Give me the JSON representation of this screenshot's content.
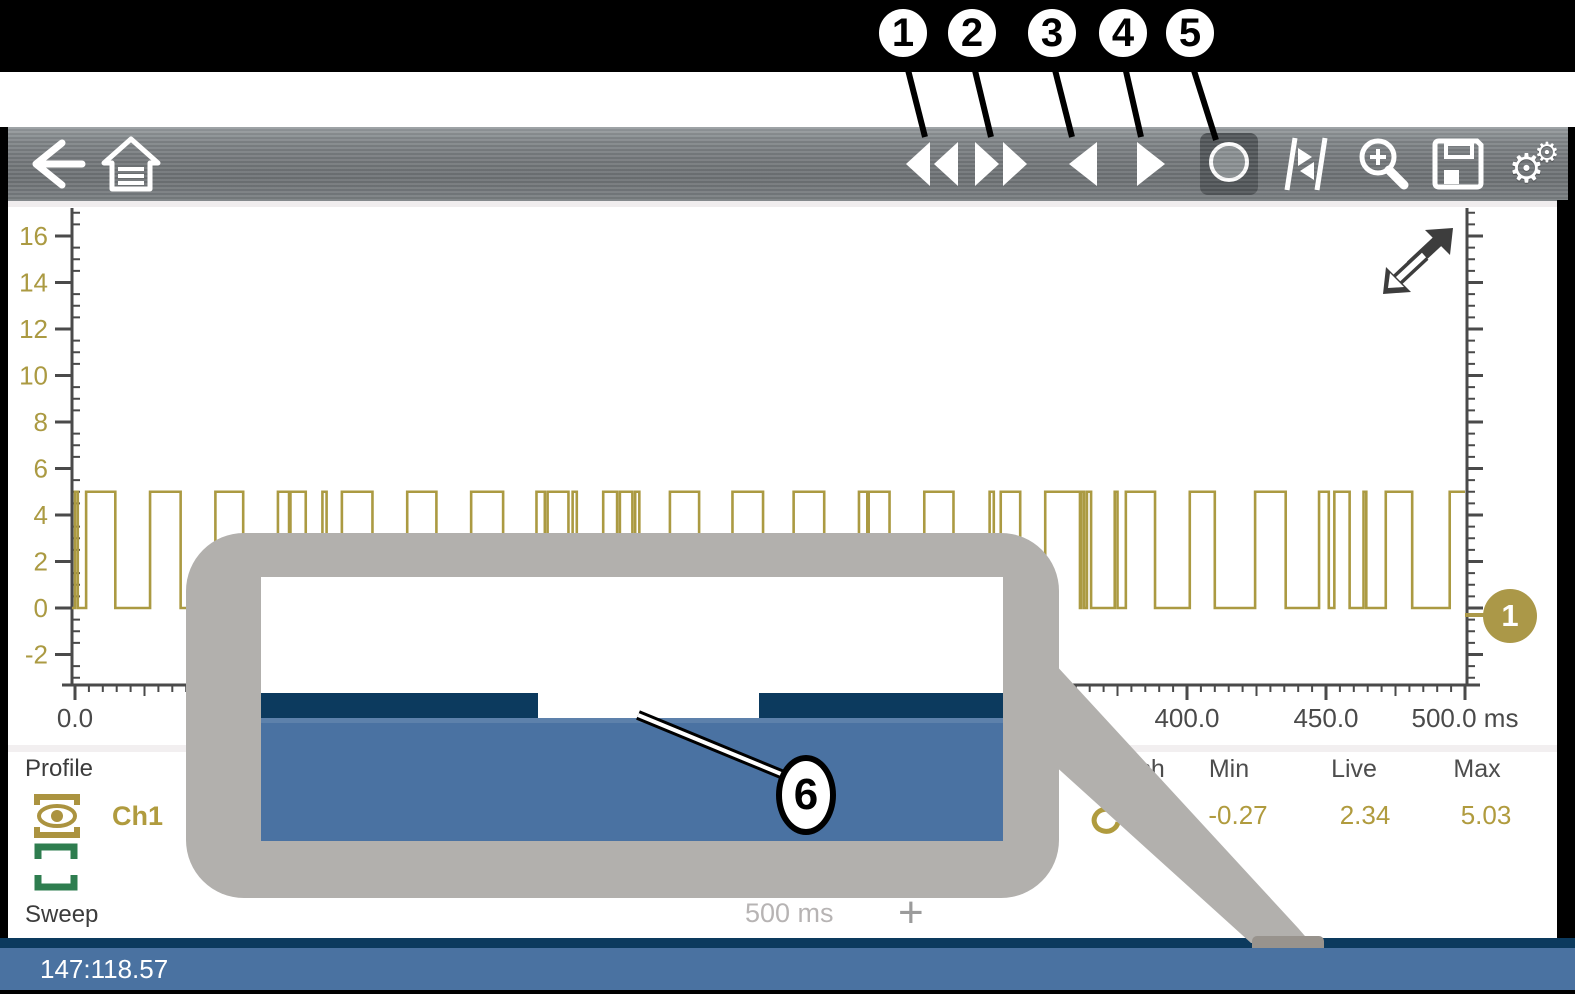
{
  "callouts": {
    "one": "1",
    "two": "2",
    "three": "3",
    "four": "4",
    "five": "5",
    "six": "6"
  },
  "toolbar": {
    "icons": [
      "back-arrow",
      "home",
      "rewind",
      "fast-forward",
      "step-back",
      "step-forward",
      "record",
      "cursors",
      "zoom-magnifier",
      "save-floppy",
      "settings-gears"
    ],
    "selected_button": "record"
  },
  "chart": {
    "badge_label": "1",
    "expand_icon": "expand-diagonal-arrows"
  },
  "chart_data": {
    "type": "line",
    "title": "",
    "description": "Digital square waveform, channel 1, toggling between 0 and 5",
    "x_unit": "ms",
    "x_range": [
      0,
      500
    ],
    "x_major_step": 50,
    "x_minor_step": 5,
    "x_tick_labels": [
      "0.0",
      "50.0",
      "100.0",
      "150.0",
      "200.0",
      "250.0",
      "300.0",
      "350.0",
      "400.0",
      "450.0",
      "500.0 ms"
    ],
    "y_major_step": 2,
    "y_tick_labels": [
      16,
      14,
      12,
      10,
      8,
      6,
      4,
      2,
      0,
      -2
    ],
    "y_range_visible": [
      -3.4,
      17.2
    ],
    "levels": {
      "low": 0,
      "high": 5
    },
    "high_segments_ms": [
      [
        0,
        1
      ],
      [
        4,
        14.5
      ],
      [
        27,
        38
      ],
      [
        50.5,
        60.5
      ],
      [
        73,
        77
      ],
      [
        77.5,
        83
      ],
      [
        89,
        90.5
      ],
      [
        96,
        107
      ],
      [
        119.5,
        130
      ],
      [
        142.5,
        154
      ],
      [
        166,
        169
      ],
      [
        170,
        177.5
      ],
      [
        179,
        180.5
      ],
      [
        190,
        195
      ],
      [
        196,
        200.5
      ],
      [
        201.5,
        203
      ],
      [
        214,
        224.5
      ],
      [
        236.5,
        247.5
      ],
      [
        258.5,
        269.5
      ],
      [
        282,
        285
      ],
      [
        285.5,
        293
      ],
      [
        305.5,
        316
      ],
      [
        329,
        330.5
      ],
      [
        333,
        340
      ],
      [
        349,
        361.5
      ],
      [
        362,
        363
      ],
      [
        364,
        365.5
      ],
      [
        374,
        375
      ],
      [
        378,
        388.5
      ],
      [
        401,
        410
      ],
      [
        424.5,
        435.5
      ],
      [
        447.5,
        451
      ],
      [
        453,
        458.5
      ],
      [
        463.5,
        464.5
      ],
      [
        471.5,
        481
      ],
      [
        494.5,
        500
      ]
    ],
    "series_color": "#ab9a42",
    "grid": false,
    "legend": false
  },
  "stats": {
    "headers": [
      "Refresh",
      "Min",
      "Live",
      "Max"
    ],
    "min": "-0.27",
    "live": "2.34",
    "max": "5.03"
  },
  "profile": {
    "section_label": "Profile",
    "channel_label": "Ch1",
    "sweep_label": "Sweep",
    "sweep_value": "500 ms",
    "add_button": "+"
  },
  "status_bar": {
    "left_text": "147:118.57"
  },
  "colors": {
    "gold": "#ab9a42",
    "gold_badge": "#ab9848",
    "navy": "#0c3a5e",
    "blue": "#4a72a1",
    "callout_gray": "#b2b0ad",
    "toolbar_gray": "#75797c"
  }
}
